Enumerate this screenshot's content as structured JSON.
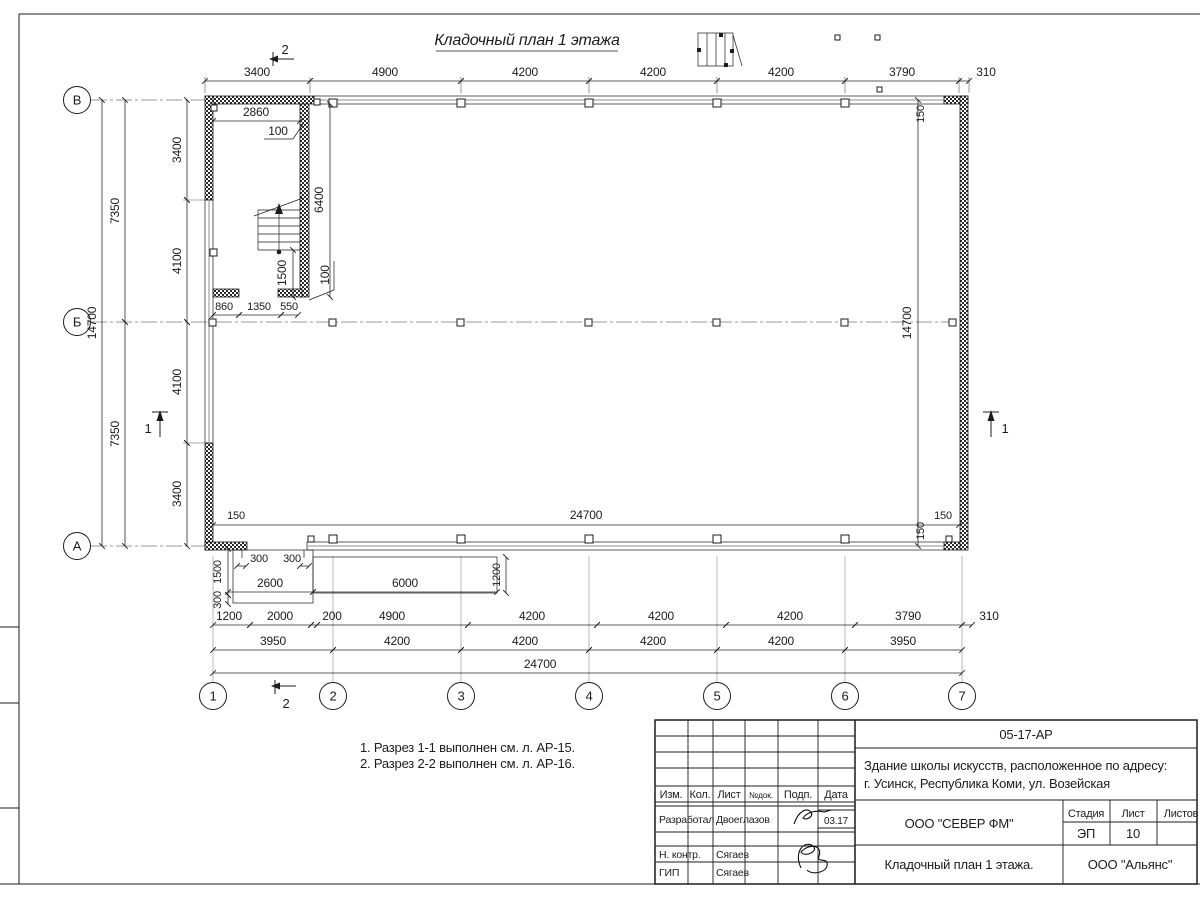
{
  "sheet": {
    "title": "Кладочный план 1 этажа",
    "notes": [
      "1. Разрез 1-1 выполнен см. л. АР-15.",
      "2. Разрез 2-2 выполнен см. л. АР-16."
    ]
  },
  "axes": {
    "rows": [
      "В",
      "Б",
      "А"
    ],
    "cols": [
      "1",
      "2",
      "3",
      "4",
      "5",
      "6",
      "7"
    ]
  },
  "sections": {
    "s1": "1",
    "s2": "2"
  },
  "dims": {
    "top": [
      "3400",
      "4900",
      "4200",
      "4200",
      "4200",
      "3790",
      "310"
    ],
    "row_a": [
      "1200",
      "2000",
      "200",
      "4900",
      "4200",
      "4200",
      "4200",
      "3790",
      "310"
    ],
    "row_b": [
      "3950",
      "4200",
      "4200",
      "4200",
      "4200",
      "3950"
    ],
    "row_c": "24700",
    "interior_width": "24700",
    "left_segments": [
      "3400",
      "4100",
      "4100",
      "3400"
    ],
    "left_halves": [
      "7350",
      "7350"
    ],
    "left_total": "14700",
    "right_total": "14700",
    "room_width": "2860",
    "room_wall": "100",
    "room_depth": "6400",
    "stair_width": "1500",
    "partition_wall": "100",
    "door_chain": [
      "860",
      "1350",
      "550"
    ],
    "porch_insets": [
      "300",
      "300"
    ],
    "porch_2600": "2600",
    "ramp_6000": "6000",
    "ramp_1200": "1200",
    "porch_1500": "1500",
    "porch_300": "300",
    "off_150_bl": "150",
    "off_150_br": "150",
    "off_150_tr": "150",
    "off_150_brv": "150"
  },
  "titleblock": {
    "doc_number": "05-17-АР",
    "project_line1": "Здание школы искусств, расположенное по адресу:",
    "project_line2": "г. Усинск, Республика Коми, ул. Возейская",
    "cols": [
      "Изм.",
      "Кол.",
      "Лист",
      "№док.",
      "Подп.",
      "Дата"
    ],
    "rows": [
      {
        "role": "Разработал",
        "name": "Двоеглазов",
        "date": "03.17"
      },
      {
        "role": "Н. контр.",
        "name": "Сягаев"
      },
      {
        "role": "ГИП",
        "name": "Сягаев"
      }
    ],
    "company": "ООО \"СЕВЕР ФМ\"",
    "stage_label": "Стадия",
    "sheet_label": "Лист",
    "sheets_label": "Листов",
    "stage": "ЭП",
    "sheet_no": "10",
    "drawing_title": "Кладочный план 1 этажа.",
    "contractor": "ООО \"Альянс\""
  }
}
